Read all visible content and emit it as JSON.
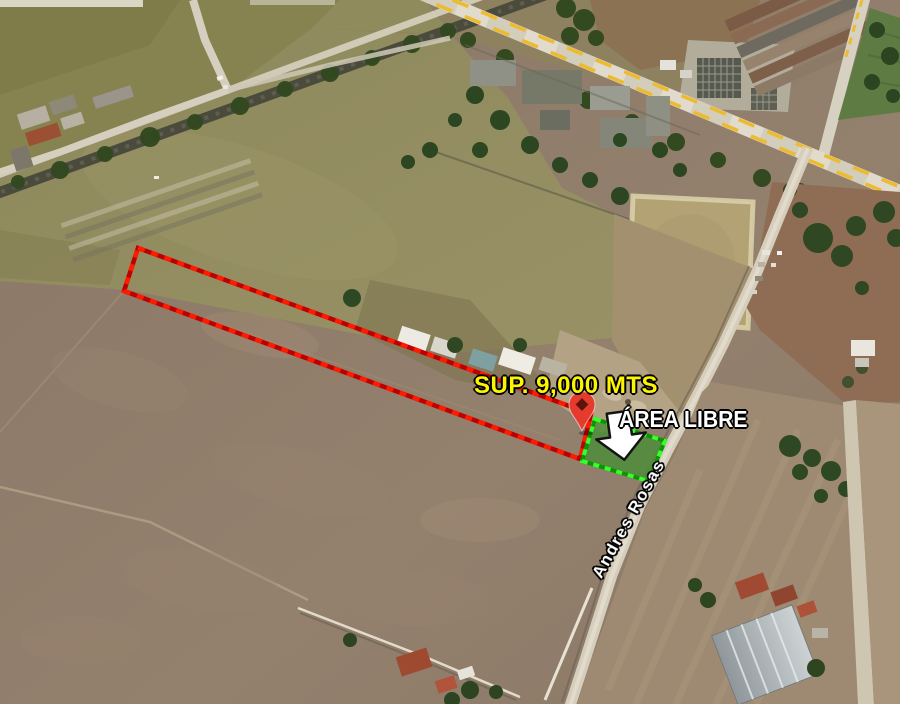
{
  "map": {
    "kind": "satellite-aerial-view",
    "surface_label": "SUP. 9,000 MTS",
    "free_area_label": "ÁREA LIBRE",
    "street_label": "Andres Rosas",
    "surface_value_mts": "9,000"
  },
  "colors": {
    "surface_label_color": "#FDF500",
    "free_area_label_color": "#FFFFFF",
    "street_label_color": "#FFFFFF",
    "parcel_outline_bright": "#ff1a00",
    "parcel_outline_dark": "#bb0000",
    "free_area_outline_bright": "#35ff2e",
    "free_area_outline_dark": "#0c9500",
    "free_area_fill": "#4f8c3a",
    "pin_color": "#e53b2c",
    "arrow_color": "#ffffff",
    "road_dash_color": "#edbb2d"
  }
}
